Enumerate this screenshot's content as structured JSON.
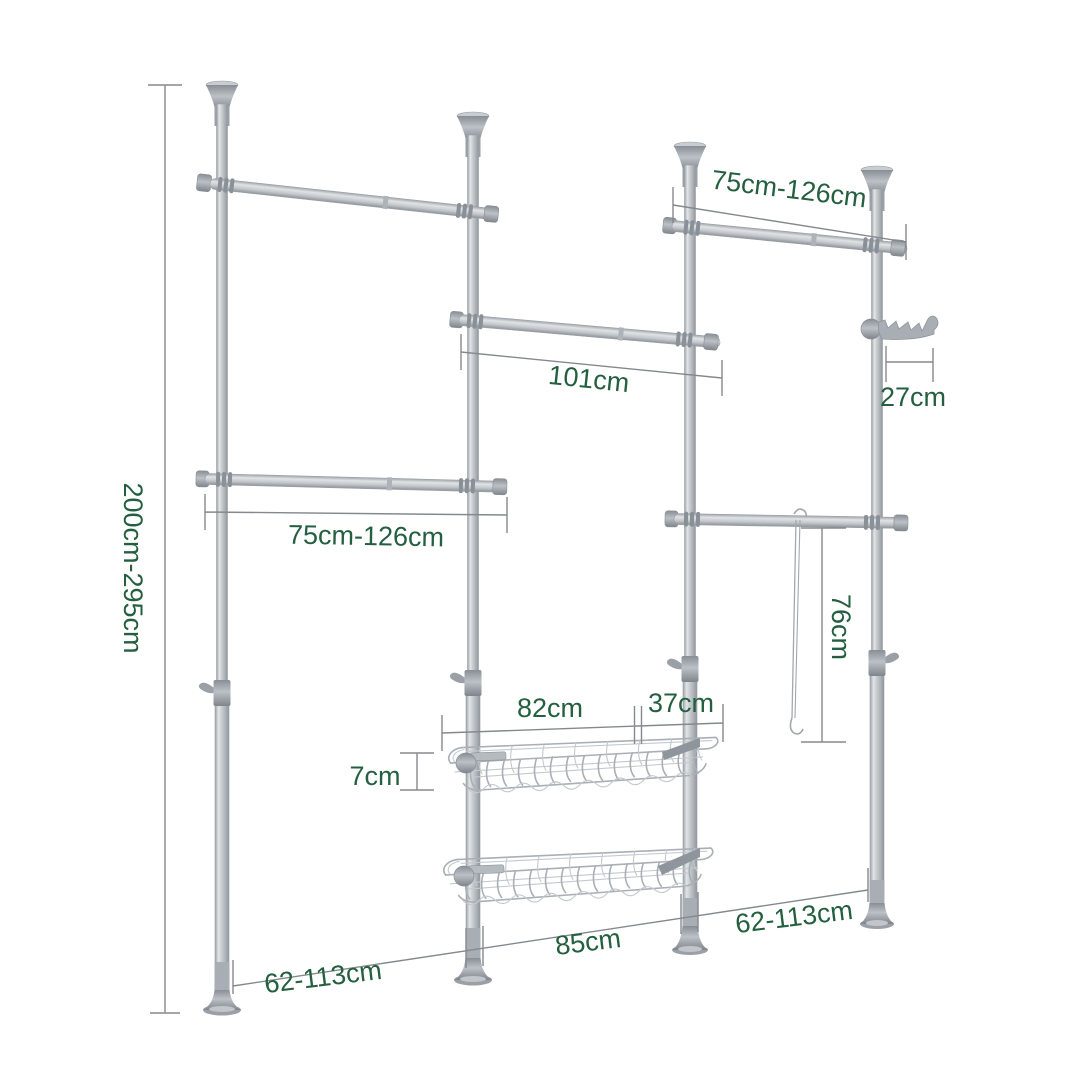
{
  "diagram": {
    "type": "product-dimension-diagram",
    "subject": "telescopic wardrobe clothes rack with rails, wire baskets and hook rack",
    "colors": {
      "background": "#ffffff",
      "label": "#24603f",
      "dimension_line": "#85898d",
      "metal_light": "#e2e5e7",
      "metal_mid": "#c6cacd",
      "metal_dark": "#8f959b"
    },
    "labels": {
      "overall_height": "200cm-295cm",
      "top_right_rail_width": "75cm-126cm",
      "left_rail_width": "75cm-126cm",
      "middle_rail_width": "101cm",
      "hook_rack_width": "27cm",
      "strap_length": "76cm",
      "basket_width": "82cm",
      "basket_offset": "37cm",
      "basket_depth": "7cm",
      "floor_span_left": "62-113cm",
      "floor_span_middle": "85cm",
      "floor_span_right": "62-113cm"
    }
  }
}
